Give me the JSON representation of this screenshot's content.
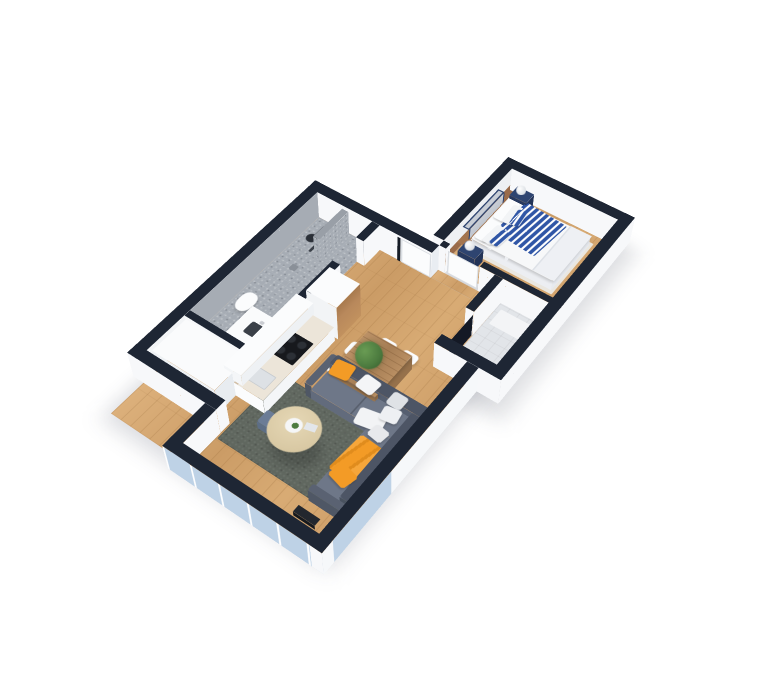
{
  "scene": {
    "description": "isometric 3d rendering of a one-bedroom apartment floor plan on a white background",
    "view": "cutaway top-down axonometric, walls capped in dark navy",
    "background": "#ffffff"
  },
  "colors": {
    "bg": "#ffffff",
    "wallTop": "#1e2634",
    "wallFace": "#f7f8fa",
    "wallShade": "#e9edf2",
    "wood": "#d2a36e",
    "mosaic": "#a6acb4",
    "tile": "#e2e5e9",
    "rug": "#60675f",
    "rugBed": "#eae7e0",
    "sofaBack": "#4d5565",
    "sofaSeat": "#6e7788",
    "sofaArm": "#5a6272",
    "orange": "#f39b26",
    "navy": "#2e4470",
    "blue": "#3056a6",
    "bedWhite": "#f7f8f9",
    "headboard": "#c9ced6",
    "woodWarm": "#9a6b4a",
    "counter": "#ece5d9",
    "dark": "#23272e",
    "glass": "#bed2e6",
    "tableWood": "#b28a62",
    "coffee": "#d9c9a4",
    "green": "#4c7b3f",
    "stool": "#6b7c96",
    "door": "#fbfcfd",
    "fridgeWood": "#b9895c"
  },
  "rooms": {
    "bedroom": {
      "floor": "wood",
      "furniture": [
        "double-bed-blue-white-chevron-bedding",
        "navy-nightstand-pair",
        "white-sphere-lamps",
        "gray-headboard-navy-frame",
        "wood-shelf",
        "light-rug"
      ]
    },
    "bathroom": {
      "floor": "gray-mosaic",
      "walls": "gray-mosaic",
      "furniture": [
        "shower-fixture",
        "partition",
        "white-vanity-with-sink",
        "toilet",
        "towel-bars"
      ]
    },
    "kitchen": {
      "floor": "wood",
      "furniture": [
        "white-counter-run",
        "black-cooktop",
        "sink",
        "wood-front-fridge",
        "upper-cabinets",
        "wood-backsplash",
        "blue-stool"
      ]
    },
    "living-dining": {
      "floor": "wood",
      "furniture": [
        "gray-l-sofa",
        "orange-pillows",
        "white-pillows",
        "orange-throw",
        "dark-speckled-rug",
        "round-coffee-table",
        "rustic-dining-table",
        "white-chairs",
        "potted-plant",
        "tv-unit"
      ],
      "windows": [
        "south-glass-wall",
        "east-glass-section"
      ]
    },
    "small-room": {
      "floor": "light-tile",
      "furniture": [
        "white-mat"
      ]
    },
    "hall": {
      "floor": "wood",
      "doors": [
        "entry-door",
        "bedroom-door",
        "bathroom-doorway"
      ]
    },
    "wardrobe-nook": {
      "furniture": [
        "white-wardrobe-unit"
      ]
    }
  }
}
